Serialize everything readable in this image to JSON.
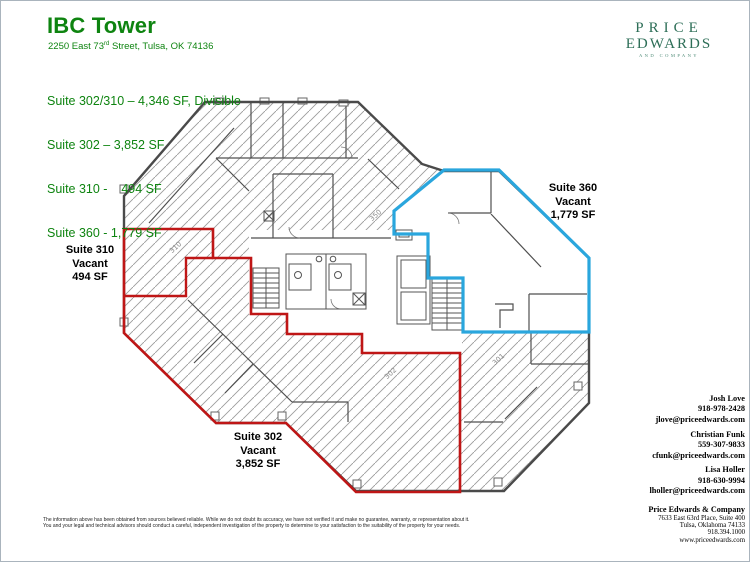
{
  "header": {
    "title": "IBC Tower",
    "address_pre": "2250 East 73",
    "address_sup": "rd",
    "address_post": " Street, Tulsa, OK  74136",
    "suite_summary": [
      "Suite 302/310 – 4,346 SF, Divisible",
      "Suite 302 – 3,852 SF",
      "Suite 310 -    494 SF",
      "Suite 360 - 1,779 SF"
    ]
  },
  "logo": {
    "line1": "PRICE",
    "line2": "EDWARDS",
    "line3": "AND COMPANY"
  },
  "colors": {
    "header_green": "#0e8410",
    "logo_green": "#2d6e57",
    "available_red": "#bf1616",
    "suite360_blue": "#2aa6dd"
  },
  "plan": {
    "suites": {
      "s310": {
        "name": "Suite 310",
        "status": "Vacant",
        "area": "494 SF"
      },
      "s360": {
        "name": "Suite 360",
        "status": "Vacant",
        "area": "1,779 SF"
      },
      "s302": {
        "name": "Suite 302",
        "status": "Vacant",
        "area": "3,852 SF"
      }
    },
    "room_numbers": [
      "310",
      "350",
      "302",
      "301"
    ]
  },
  "contacts": [
    {
      "name": "Josh Love",
      "phone": "918-978-2428",
      "email": "jlove@priceedwards.com"
    },
    {
      "name": "Christian Funk",
      "phone": "559-307-9833",
      "email": "cfunk@priceedwards.com"
    },
    {
      "name": "Lisa Holler",
      "phone": "918-630-9994",
      "email": "lholler@priceedwards.com"
    }
  ],
  "company": {
    "name": "Price Edwards & Company",
    "address1": "7633 East 63rd Place, Suite 400",
    "address2": "Tulsa, Oklahoma  74133",
    "phone": "918.394.1000",
    "website": "www.priceedwards.com"
  },
  "disclaimer": {
    "line1": "The information above has been obtained from sources believed reliable.  While we do not doubt its accuracy, we have not verified it and make no guarantee, warranty, or representation about it.",
    "line2": "You and your legal and technical advisors should conduct a careful, independent investigation of the property to determine to your satisfaction to the suitability of the property for your needs."
  }
}
